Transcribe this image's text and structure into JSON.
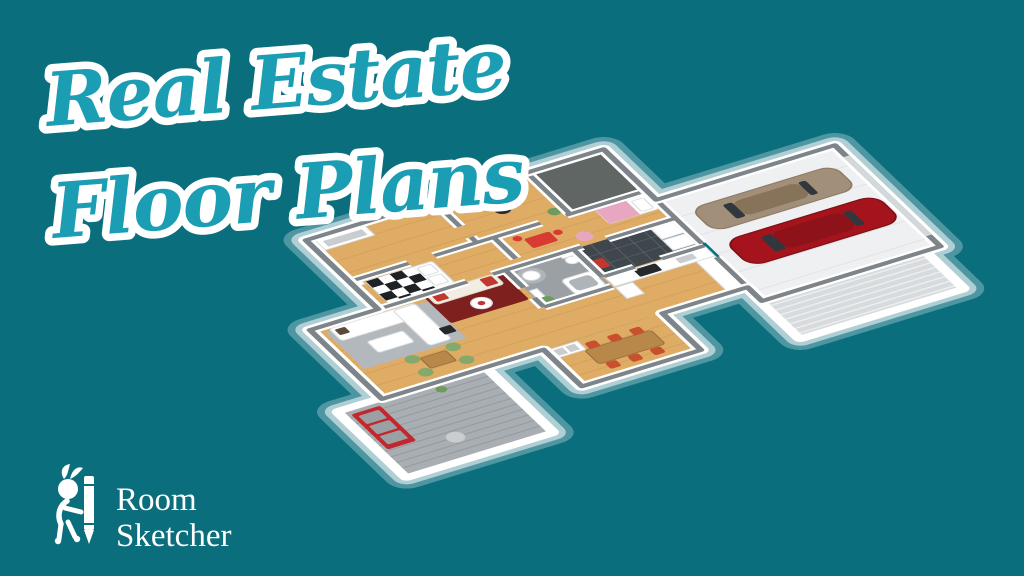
{
  "title": {
    "line1": "Real Estate",
    "line2": "Floor Plans"
  },
  "logo": {
    "line1": "Room",
    "line2": "Sketcher"
  },
  "illustration": {
    "type": "3d-floor-plan",
    "subject": "Isometric 3D floor plan of a single-story home with bedrooms, office, kids room, bathroom, kitchen, utility room, living room, dining area, outdoor deck with red bench, driveway, and a garage containing a tan car and a red car"
  },
  "colors": {
    "background": "#0B6E7D",
    "title_text": "#1B9EB3",
    "title_outline": "#FFFFFF",
    "logo_text": "#FFFFFF",
    "slab_white": "#FFFFFF",
    "wall_top": "#7D848A",
    "wall_face": "#FFFFFF",
    "wood_floor": "#DFAC66",
    "wood_plank": "#C8954F",
    "deck_floor": "#A9AEB2",
    "deck_plank": "#8F969B",
    "tile_floor": "#9AA0A4",
    "dark_tile": "#3F464C",
    "carpet_dark": "#5F6664",
    "garage_floor": "#EEF0F2",
    "driveway": "#D7DBDE",
    "rug_gray": "#B3B8BC",
    "rug_red": "#7E201D",
    "sofa_cream": "#F2EDE3",
    "cushion_red": "#C23730",
    "bench_red": "#C1272D",
    "chair_green": "#85A86B",
    "chair_orange": "#C7512E",
    "table_wood": "#B8884A",
    "wood_desk": "#5A4A3C",
    "stove_black": "#26292C",
    "plant_green": "#6E9A5E",
    "kids_table_red": "#D93A31",
    "pink_blanket": "#E8A7C0",
    "checker_dark": "#1F2225",
    "car_tan": "#A28F7A",
    "car_tan_roof": "#877359",
    "car_red": "#A5131C",
    "car_red_roof": "#8E1219",
    "car_window": "#31373C"
  }
}
